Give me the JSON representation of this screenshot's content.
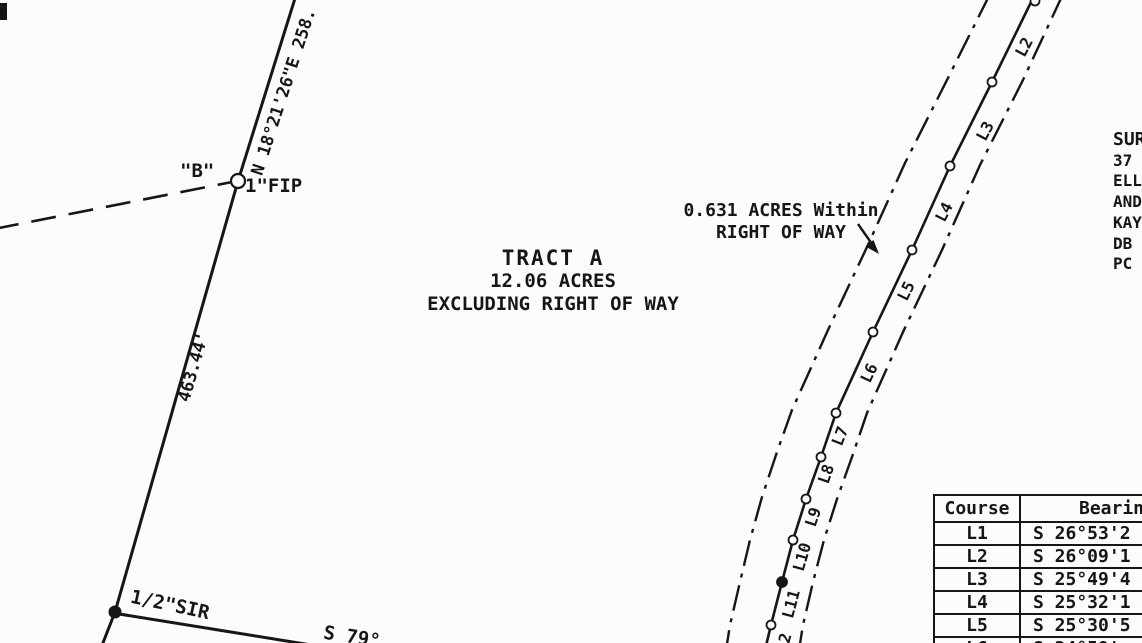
{
  "tract": {
    "title": "TRACT A",
    "area": "12.06 ACRES",
    "qualifier": "EXCLUDING RIGHT OF WAY"
  },
  "row_note": {
    "line1": "0.631 ACRES Within",
    "line2": "RIGHT OF WAY"
  },
  "boundary": {
    "bearing_upper": "N 18°21'26\"E 258.",
    "distance_left": "463.44'",
    "bearing_lower_partial": "S 79°",
    "point_b_label": "\"B\"",
    "point_b_marker": "1\"FIP",
    "sir_marker": "1/2\"SIR"
  },
  "road": {
    "course_labels": [
      "L2",
      "L3",
      "L4",
      "L5",
      "L6",
      "L7",
      "L8",
      "L9",
      "L10",
      "L11",
      "2"
    ]
  },
  "notes_block": {
    "lines": [
      "SUR",
      "37",
      "ELL",
      "AND",
      "KAY",
      "DB",
      "PC"
    ]
  },
  "course_table": {
    "headers": [
      "Course",
      "Bearing"
    ],
    "rows": [
      [
        "L1",
        "S 26°53'2"
      ],
      [
        "L2",
        "S 26°09'1"
      ],
      [
        "L3",
        "S 25°49'4"
      ],
      [
        "L4",
        "S 25°32'1"
      ],
      [
        "L5",
        "S 25°30'5"
      ],
      [
        "L6",
        "S 24°59'"
      ]
    ]
  },
  "colors": {
    "ink": "#161616",
    "paper": "#fcfcfb"
  }
}
